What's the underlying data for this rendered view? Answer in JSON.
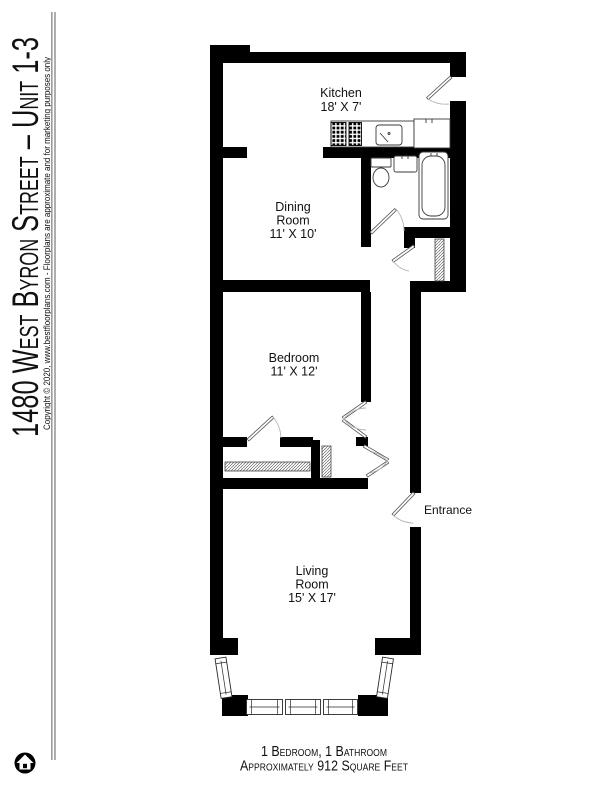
{
  "sidebar": {
    "title": "1480 West Byron Street – Unit 1-3",
    "copyright": "Copyright © 2020, www.bestfloorplans.com - Floorplans are approximate and for marketing purposes only"
  },
  "rooms": {
    "kitchen": {
      "lines": [
        "Kitchen",
        "18' X 7'"
      ]
    },
    "dining": {
      "lines": [
        "Dining",
        "Room",
        "11' X 10'"
      ]
    },
    "bedroom": {
      "lines": [
        "Bedroom",
        "11' X 12'"
      ]
    },
    "living": {
      "lines": [
        "Living",
        "Room",
        "15' X 17'"
      ]
    }
  },
  "labels": {
    "entrance": "Entrance"
  },
  "footer": {
    "line1": "1 Bedroom, 1 Bathroom",
    "line2": "Approximately 912 Square Feet"
  },
  "icons": {
    "logo": "house-in-circle-icon"
  },
  "colors": {
    "wall": "#000000",
    "fixture_outline": "#3a3a3a",
    "door_arc": "#b5b5b5",
    "rule": "#9b9b9b",
    "text": "#111111",
    "background": "#ffffff"
  }
}
